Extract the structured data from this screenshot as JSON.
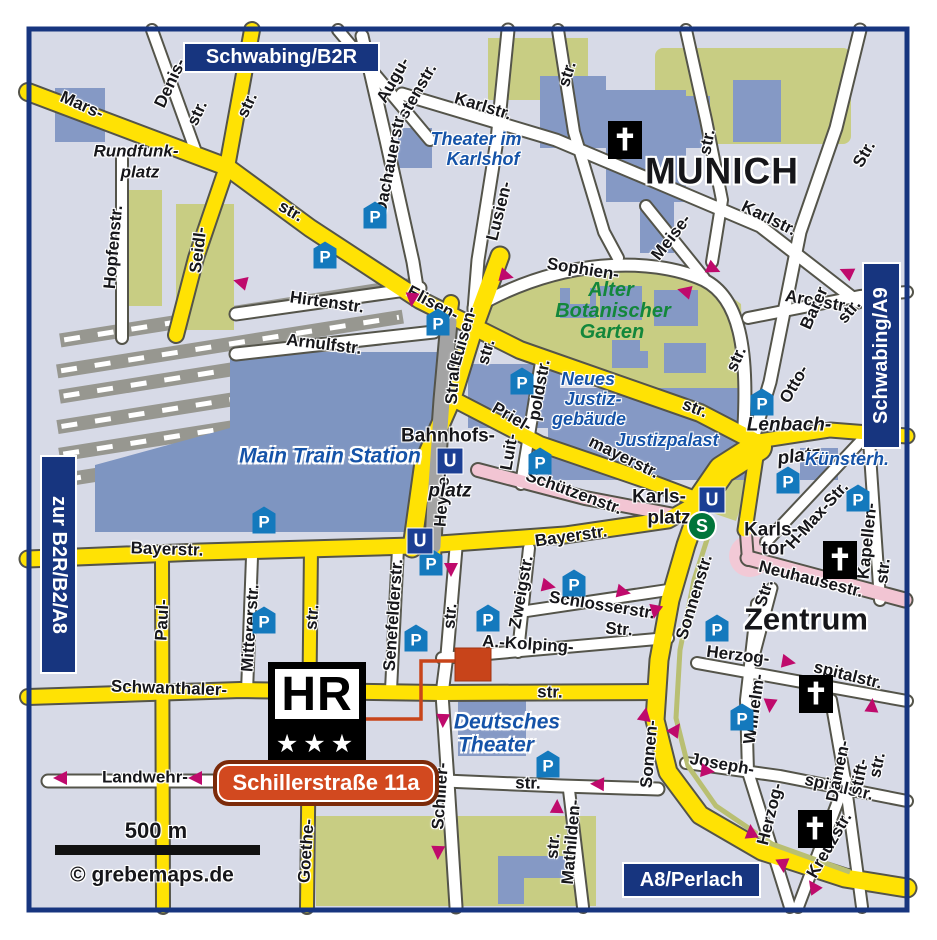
{
  "title": "Munich city map with hotel location",
  "edge_labels": {
    "top": "Schwabing/B2R",
    "right": "Schwabing/A9",
    "left": "zur B2R/B2/A8",
    "bottom": "A8/Perlach"
  },
  "hotel": {
    "logo_text": "HR",
    "stars": "★★★",
    "badge": "Schillerstraße 11a"
  },
  "scale": {
    "text": "500 m"
  },
  "copyright": "© grebemaps.de",
  "colors": {
    "background": "#d7dae7",
    "road_major": "#ffe204",
    "road_minor": "#ffffff",
    "road_pedestrian": "#f2c5d3",
    "road_tunnel": "#a3a3a3",
    "park": "#c8cd83",
    "building": "#8599c5",
    "frame_navy": "#17357f",
    "arrow_magenta": "#bf0a6c",
    "parking_blue": "#1479bd",
    "sbahn_green": "#00753a",
    "hotel_red": "#c8441a",
    "poi_text_blue": "#1553a8",
    "park_text_green": "#13873b"
  },
  "icons": {
    "parking": {
      "glyph": "P",
      "positions": [
        [
          375,
          215
        ],
        [
          325,
          255
        ],
        [
          438,
          322
        ],
        [
          522,
          381
        ],
        [
          540,
          461
        ],
        [
          264,
          520
        ],
        [
          264,
          620
        ],
        [
          574,
          583
        ],
        [
          488,
          618
        ],
        [
          416,
          638
        ],
        [
          431,
          562
        ],
        [
          548,
          764
        ],
        [
          762,
          402
        ],
        [
          788,
          480
        ],
        [
          858,
          498
        ],
        [
          717,
          628
        ],
        [
          742,
          717
        ]
      ]
    },
    "metro": {
      "glyph": "U",
      "positions": [
        [
          450,
          461
        ],
        [
          420,
          541
        ],
        [
          712,
          500
        ]
      ]
    },
    "sbahn": {
      "glyph": "S",
      "positions": [
        [
          702,
          526
        ]
      ]
    },
    "church": {
      "glyph": "✝",
      "positions": [
        [
          625,
          140
        ],
        [
          840,
          560
        ],
        [
          816,
          694
        ],
        [
          815,
          829
        ]
      ]
    },
    "arrows": [
      [
        240,
        282,
        195
      ],
      [
        412,
        300,
        95
      ],
      [
        507,
        276,
        15
      ],
      [
        714,
        269,
        25
      ],
      [
        684,
        291,
        195
      ],
      [
        846,
        272,
        205
      ],
      [
        451,
        570,
        90
      ],
      [
        549,
        586,
        12
      ],
      [
        624,
        592,
        12
      ],
      [
        655,
        612,
        100
      ],
      [
        443,
        721,
        92
      ],
      [
        438,
        853,
        92
      ],
      [
        60,
        778,
        180
      ],
      [
        195,
        778,
        180
      ],
      [
        597,
        784,
        182
      ],
      [
        557,
        806,
        -88
      ],
      [
        645,
        714,
        -80
      ],
      [
        676,
        729,
        -55
      ],
      [
        708,
        771,
        8
      ],
      [
        789,
        662,
        10
      ],
      [
        770,
        706,
        95
      ],
      [
        872,
        705,
        -85
      ],
      [
        751,
        831,
        -95
      ],
      [
        783,
        866,
        85
      ],
      [
        813,
        886,
        -125
      ]
    ]
  },
  "labels": [
    {
      "t": "Mars-",
      "x": 82,
      "y": 105,
      "r": 24,
      "c": "st"
    },
    {
      "t": "str.",
      "x": 247,
      "y": 105,
      "r": -65,
      "c": "st"
    },
    {
      "t": "str.",
      "x": 291,
      "y": 211,
      "r": 30,
      "c": "st"
    },
    {
      "t": "Denis-",
      "x": 170,
      "y": 83,
      "r": -65,
      "c": "st"
    },
    {
      "t": "str.",
      "x": 197,
      "y": 113,
      "r": -65,
      "c": "st"
    },
    {
      "t": "Seidl-",
      "x": 198,
      "y": 250,
      "r": -83,
      "c": "st"
    },
    {
      "t": "Hopfenstr.",
      "x": 113,
      "y": 247,
      "r": -85,
      "c": "st"
    },
    {
      "t": "Straße",
      "x": 453,
      "y": 378,
      "r": -86,
      "c": "st"
    },
    {
      "t": "Heyse-",
      "x": 442,
      "y": 499,
      "r": -86,
      "c": "st"
    },
    {
      "t": "Augu-",
      "x": 393,
      "y": 80,
      "r": -60,
      "c": "st"
    },
    {
      "t": "stenstr.",
      "x": 417,
      "y": 91,
      "r": -60,
      "c": "st"
    },
    {
      "t": "Dachauerstr.",
      "x": 390,
      "y": 163,
      "r": -79,
      "c": "st"
    },
    {
      "t": "Karlstr.",
      "x": 483,
      "y": 106,
      "r": 17,
      "c": "st"
    },
    {
      "t": "str.",
      "x": 567,
      "y": 74,
      "r": -73,
      "c": "st"
    },
    {
      "t": "Lusien-",
      "x": 499,
      "y": 211,
      "r": -76,
      "c": "st"
    },
    {
      "t": "Karlstr.",
      "x": 769,
      "y": 218,
      "r": 26,
      "c": "st"
    },
    {
      "t": "Meise-",
      "x": 671,
      "y": 237,
      "r": -52,
      "c": "st"
    },
    {
      "t": "str.",
      "x": 707,
      "y": 142,
      "r": -79,
      "c": "st"
    },
    {
      "t": "Str.",
      "x": 864,
      "y": 154,
      "r": -60,
      "c": "st"
    },
    {
      "t": "Elisen-",
      "x": 433,
      "y": 303,
      "r": 28,
      "c": "st"
    },
    {
      "t": "Luisen-",
      "x": 463,
      "y": 336,
      "r": -74,
      "c": "st"
    },
    {
      "t": "str.",
      "x": 486,
      "y": 352,
      "r": -74,
      "c": "st"
    },
    {
      "t": "str.",
      "x": 695,
      "y": 408,
      "r": 21,
      "c": "st"
    },
    {
      "t": "Sophien-",
      "x": 583,
      "y": 269,
      "r": 9,
      "c": "st"
    },
    {
      "t": "str.",
      "x": 736,
      "y": 359,
      "r": -65,
      "c": "st"
    },
    {
      "t": "Arcostr.",
      "x": 817,
      "y": 301,
      "r": 10,
      "c": "st"
    },
    {
      "t": "Barer",
      "x": 814,
      "y": 308,
      "r": -66,
      "c": "st"
    },
    {
      "t": "str.",
      "x": 849,
      "y": 311,
      "r": -50,
      "c": "st"
    },
    {
      "t": "Otto-",
      "x": 794,
      "y": 384,
      "r": -60,
      "c": "st"
    },
    {
      "t": "Hirtenstr.",
      "x": 327,
      "y": 302,
      "r": 8,
      "c": "st"
    },
    {
      "t": "Arnulfstr.",
      "x": 324,
      "y": 344,
      "r": 7,
      "c": "st"
    },
    {
      "t": "Priel-",
      "x": 512,
      "y": 417,
      "r": 30,
      "c": "st"
    },
    {
      "t": "mayerstr.",
      "x": 624,
      "y": 457,
      "r": 26,
      "c": "st"
    },
    {
      "t": "poldstr.",
      "x": 539,
      "y": 390,
      "r": -80,
      "c": "st"
    },
    {
      "t": "Luit-",
      "x": 509,
      "y": 452,
      "r": -80,
      "c": "st"
    },
    {
      "t": "Schützenstr.",
      "x": 574,
      "y": 492,
      "r": 20,
      "c": "st"
    },
    {
      "t": "Bayerstr.",
      "x": 167,
      "y": 549,
      "r": 2,
      "c": "st"
    },
    {
      "t": "Bayerstr.",
      "x": 571,
      "y": 536,
      "r": -8,
      "c": "st"
    },
    {
      "t": "str.",
      "x": 312,
      "y": 617,
      "r": -85,
      "c": "st"
    },
    {
      "t": "Goethe-",
      "x": 306,
      "y": 851,
      "r": -86,
      "c": "st"
    },
    {
      "t": "Paul-",
      "x": 162,
      "y": 620,
      "r": -87,
      "c": "st"
    },
    {
      "t": "Mittererstr.",
      "x": 250,
      "y": 628,
      "r": -86,
      "c": "st"
    },
    {
      "t": "Senefelderstr.",
      "x": 393,
      "y": 615,
      "r": -86,
      "c": "st"
    },
    {
      "t": "Zweigstr.",
      "x": 521,
      "y": 592,
      "r": -80,
      "c": "st"
    },
    {
      "t": "Schlosserstr.",
      "x": 602,
      "y": 605,
      "r": 9,
      "c": "st"
    },
    {
      "t": "A.-Kolping-",
      "x": 528,
      "y": 644,
      "r": 4,
      "c": "st"
    },
    {
      "t": "Str.",
      "x": 619,
      "y": 629,
      "r": 4,
      "c": "st"
    },
    {
      "t": "Schwanthaler-",
      "x": 169,
      "y": 688,
      "r": 2,
      "c": "st"
    },
    {
      "t": "str.",
      "x": 550,
      "y": 692,
      "r": 1,
      "c": "st"
    },
    {
      "t": "str.",
      "x": 450,
      "y": 616,
      "r": -85,
      "c": "st"
    },
    {
      "t": "Schiller-",
      "x": 440,
      "y": 796,
      "r": -86,
      "c": "st"
    },
    {
      "t": "Landwehr-",
      "x": 145,
      "y": 777,
      "r": 0,
      "c": "st"
    },
    {
      "t": "str.",
      "x": 528,
      "y": 783,
      "r": 1,
      "c": "st"
    },
    {
      "t": "Mathilden-",
      "x": 571,
      "y": 842,
      "r": -85,
      "c": "st"
    },
    {
      "t": "str.",
      "x": 553,
      "y": 846,
      "r": -85,
      "c": "st"
    },
    {
      "t": "Sonnenstr.",
      "x": 694,
      "y": 597,
      "r": -73,
      "c": "st"
    },
    {
      "t": "Sonnen-",
      "x": 649,
      "y": 754,
      "r": -85,
      "c": "st"
    },
    {
      "t": "Joseph-",
      "x": 722,
      "y": 764,
      "r": 10,
      "c": "st"
    },
    {
      "t": "spitalstr.",
      "x": 839,
      "y": 787,
      "r": 13,
      "c": "st"
    },
    {
      "t": "Herzog-",
      "x": 738,
      "y": 655,
      "r": 7,
      "c": "st"
    },
    {
      "t": "spitalstr.",
      "x": 848,
      "y": 675,
      "r": 14,
      "c": "st"
    },
    {
      "t": "Wilhelm-",
      "x": 754,
      "y": 709,
      "r": -82,
      "c": "st"
    },
    {
      "t": "Herzog-",
      "x": 770,
      "y": 814,
      "r": -76,
      "c": "st"
    },
    {
      "t": "Kreuzstr.",
      "x": 829,
      "y": 845,
      "r": -60,
      "c": "st"
    },
    {
      "t": "Damen-",
      "x": 838,
      "y": 771,
      "r": -78,
      "c": "st"
    },
    {
      "t": "stift-",
      "x": 859,
      "y": 777,
      "r": -78,
      "c": "st"
    },
    {
      "t": "str.",
      "x": 877,
      "y": 765,
      "r": -78,
      "c": "st"
    },
    {
      "t": "Neuhausestr.",
      "x": 811,
      "y": 579,
      "r": 14,
      "c": "st"
    },
    {
      "t": "H-Max-Str.",
      "x": 817,
      "y": 515,
      "r": -48,
      "c": "st"
    },
    {
      "t": "Kapellen-",
      "x": 867,
      "y": 541,
      "r": -84,
      "c": "st"
    },
    {
      "t": "str.",
      "x": 883,
      "y": 571,
      "r": -84,
      "c": "st"
    },
    {
      "t": "Str.",
      "x": 764,
      "y": 593,
      "r": -73,
      "c": "st"
    },
    {
      "t": "Karls-",
      "x": 659,
      "y": 497,
      "r": 0,
      "c": "plaza"
    },
    {
      "t": "platz",
      "x": 669,
      "y": 518,
      "r": 0,
      "c": "plaza"
    },
    {
      "t": "Karls-",
      "x": 771,
      "y": 530,
      "r": 0,
      "c": "plaza"
    },
    {
      "t": "tor",
      "x": 774,
      "y": 549,
      "r": 0,
      "c": "plaza"
    },
    {
      "t": "Lenbach-",
      "x": 789,
      "y": 425,
      "r": 0,
      "c": "plazait"
    },
    {
      "t": "platz",
      "x": 799,
      "y": 456,
      "r": -8,
      "c": "plazait"
    },
    {
      "t": "Bahnhofs-",
      "x": 448,
      "y": 436,
      "r": 0,
      "c": "plaza"
    },
    {
      "t": "platz",
      "x": 450,
      "y": 491,
      "r": 0,
      "c": "plazait"
    },
    {
      "t": "Rundfunk-",
      "x": 136,
      "y": 151,
      "r": 0,
      "c": "stit"
    },
    {
      "t": "platz",
      "x": 140,
      "y": 172,
      "r": 0,
      "c": "stit"
    },
    {
      "t": "Theater im",
      "x": 476,
      "y": 139,
      "r": 0,
      "c": "poi"
    },
    {
      "t": "Karlshof",
      "x": 483,
      "y": 159,
      "r": 0,
      "c": "poi"
    },
    {
      "t": "Neues",
      "x": 588,
      "y": 379,
      "r": 0,
      "c": "poi"
    },
    {
      "t": "Justiz-",
      "x": 593,
      "y": 399,
      "r": 0,
      "c": "poi"
    },
    {
      "t": "gebäude",
      "x": 589,
      "y": 419,
      "r": 0,
      "c": "poi"
    },
    {
      "t": "Justizpalast",
      "x": 667,
      "y": 440,
      "r": 0,
      "c": "poi"
    },
    {
      "t": "Main Train Station",
      "x": 330,
      "y": 456,
      "r": 0,
      "c": "poib"
    },
    {
      "t": "Künsterh.",
      "x": 847,
      "y": 459,
      "r": 0,
      "c": "poi"
    },
    {
      "t": "Deutsches",
      "x": 507,
      "y": 722,
      "r": 0,
      "c": "poib"
    },
    {
      "t": "Theater",
      "x": 496,
      "y": 745,
      "r": 0,
      "c": "poib"
    },
    {
      "t": "Alter",
      "x": 611,
      "y": 290,
      "r": 0,
      "c": "park"
    },
    {
      "t": "Botanischer",
      "x": 613,
      "y": 311,
      "r": 0,
      "c": "park"
    },
    {
      "t": "Garten",
      "x": 612,
      "y": 332,
      "r": 0,
      "c": "park"
    },
    {
      "t": "MUNICH",
      "x": 722,
      "y": 171,
      "r": 0,
      "c": "city"
    },
    {
      "t": "Zentrum",
      "x": 806,
      "y": 619,
      "r": 0,
      "c": "city2"
    },
    {
      "t": "500 m",
      "x": 156,
      "y": 831,
      "r": 0,
      "c": "scale"
    },
    {
      "t": "© grebemaps.de",
      "x": 152,
      "y": 875,
      "r": 0,
      "c": "copy"
    }
  ]
}
